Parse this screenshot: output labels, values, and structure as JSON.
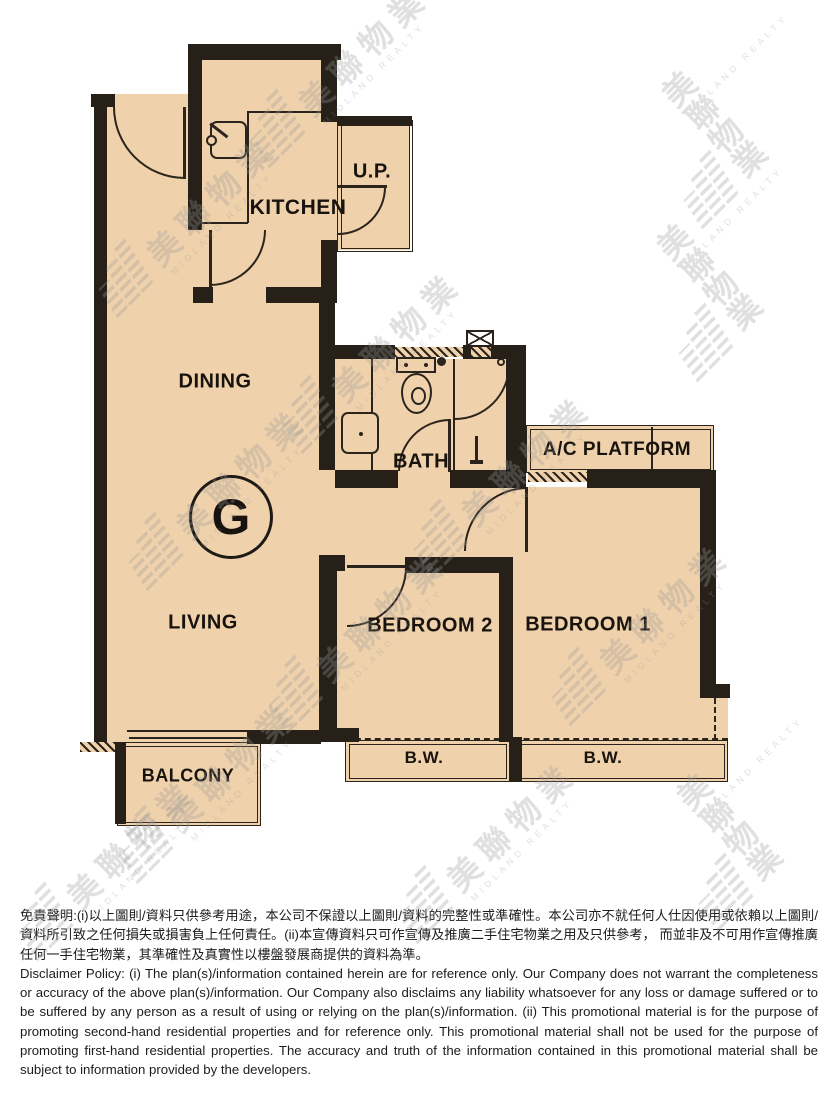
{
  "page": {
    "background": "#ffffff"
  },
  "floorplan": {
    "unit_label": "G",
    "rooms": {
      "kitchen": "KITCHEN",
      "utility_platform": "U.P.",
      "dining": "DINING",
      "living": "LIVING",
      "bath": "BATH",
      "ac_platform": "A/C PLATFORM",
      "bedroom2": "BEDROOM 2",
      "bedroom1": "BEDROOM 1",
      "balcony": "BALCONY",
      "bay_window_left": "B.W.",
      "bay_window_right": "B.W."
    },
    "colors": {
      "floor_fill": "#efd2ab",
      "wall": "#262019",
      "line": "#2b241d"
    }
  },
  "watermark": {
    "brand_zh": "美聯物業",
    "brand_en": "MIDLAND REALTY",
    "color": "#9a9a9a"
  },
  "disclaimer": {
    "zh": "免責聲明:(i)以上圖則/資料只供參考用途，本公司不保證以上圖則/資料的完整性或準確性。本公司亦不就任何人仕因使用或依賴以上圖則/資料所引致之任何損失或損害負上任何責任。(ii)本宣傳資料只可作宣傳及推廣二手住宅物業之用及只供參考， 而並非及不可用作宣傳推廣任何一手住宅物業，其準確性及真實性以樓盤發展商提供的資料為準。",
    "en": "Disclaimer Policy: (i) The plan(s)/information contained herein are for reference only. Our Company does not warrant the completeness or accuracy of the above plan(s)/information. Our Company also disclaims any liability whatsoever for any loss or damage suffered or to be suffered by any person as a result of using or relying on the plan(s)/information. (ii) This promotional material is for the purpose of promoting second-hand residential properties and for reference only. This promotional material shall not be used for the purpose of promoting first-hand residential properties. The accuracy and truth of the information contained in this promotional material shall be subject to information provided by the developers."
  }
}
